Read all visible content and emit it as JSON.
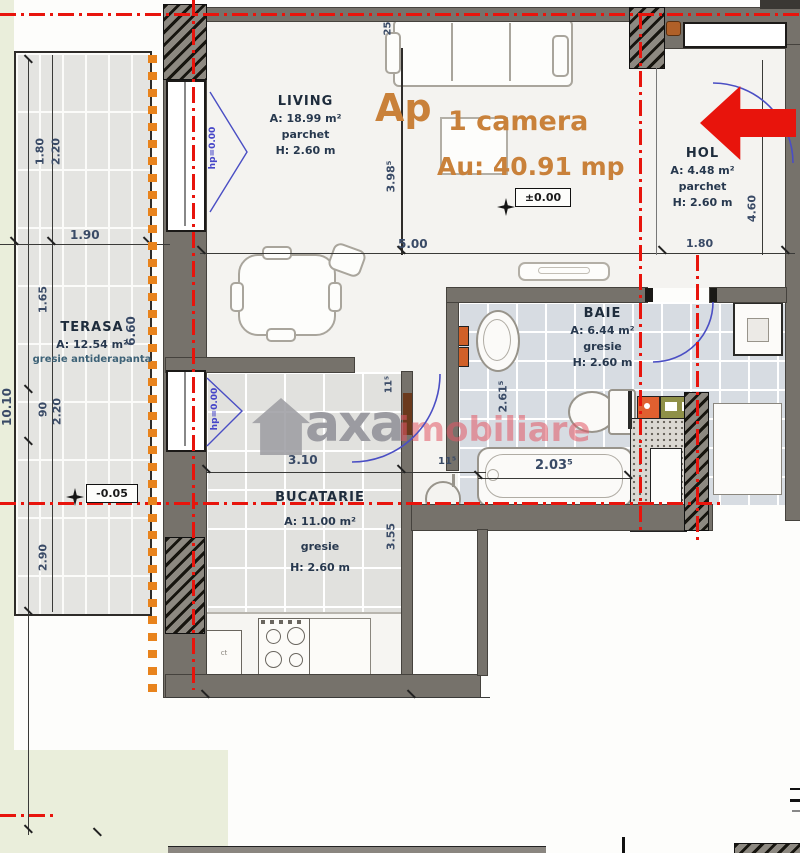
{
  "header": {
    "ap": "Ap",
    "camera": "1 camera",
    "au": "Au: 40.91 mp"
  },
  "rooms": {
    "living": {
      "name": "LIVING",
      "area": "A: 18.99 m²",
      "floor": "parchet",
      "height": "H: 2.60 m"
    },
    "hol": {
      "name": "HOL",
      "area": "A: 4.48 m²",
      "floor": "parchet",
      "height": "H: 2.60 m"
    },
    "baie": {
      "name": "BAIE",
      "area": "A: 6.44 m²",
      "floor": "gresie",
      "height": "H: 2.60 m"
    },
    "bucatarie": {
      "name": "BUCATARIE",
      "area": "A: 11.00 m²",
      "floor": "gresie",
      "height": "H: 2.60 m"
    },
    "terasa": {
      "name": "TERASA",
      "area": "A: 12.54 m²",
      "floor": "gresie antiderapanta"
    }
  },
  "levels": {
    "zero": "±0.00",
    "minus": "-0.05",
    "hp_living": "hp=0.00",
    "hp_kitchen": "hp=0.00"
  },
  "dims": {
    "t_190": "1.90",
    "t_180": "1.80",
    "t_220a": "2.20",
    "t_165": "1.65",
    "t_90": "90",
    "t_220b": "2.20",
    "t_290": "2.90",
    "t_1010": "10.10",
    "t_660": "6.60",
    "l_398": "3.98⁵",
    "l_25": "25",
    "l_500": "5.00",
    "h_180": "1.80",
    "h_460": "4.60",
    "k_310": "3.10",
    "k_115a": "11⁵",
    "k_115b": "11⁵",
    "k_355": "3.55",
    "b_261": "2.61⁵",
    "b_203": "2.03⁵"
  },
  "kitchen": {
    "cabinet_label": "ct"
  },
  "watermark": {
    "brand": "axa",
    "suffix": "imobiliare"
  },
  "colors": {
    "accent_orange": "#c9813a",
    "axis_red": "#e8140c",
    "marker_orange": "#e8831c",
    "arrow_red": "#e8140c",
    "door_blue": "#4a4ec4",
    "wall_gray": "#76726b",
    "label_navy": "#1e2c3c",
    "dim_blue": "#394a66",
    "watermark_gray": "#9b9ba1",
    "watermark_pink": "#e25866"
  }
}
